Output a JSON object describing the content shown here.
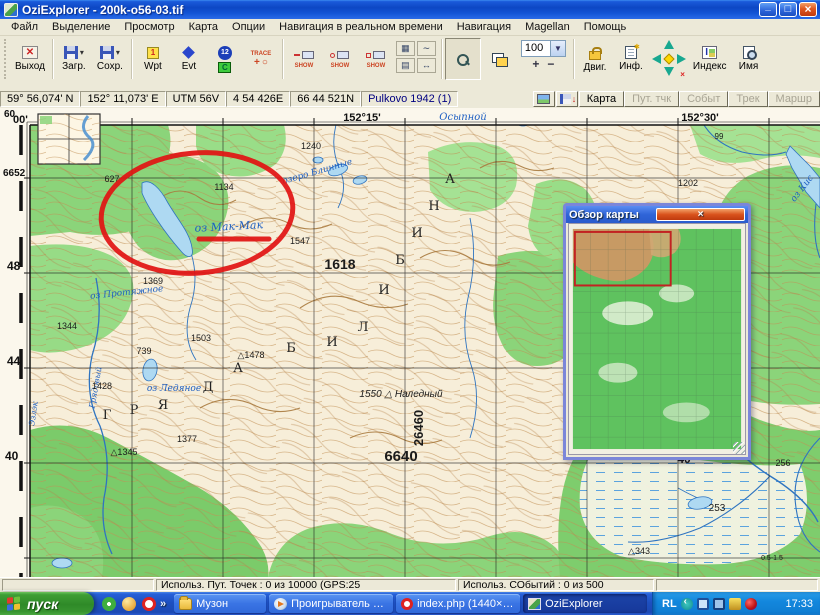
{
  "window": {
    "title": "OziExplorer - 200k-o56-03.tif"
  },
  "menu": {
    "items": [
      "Файл",
      "Выделение",
      "Просмотр",
      "Карта",
      "Опции",
      "Навигация в реальном времени",
      "Навигация",
      "Magellan",
      "Помощь"
    ]
  },
  "toolbar": {
    "exit": "Выход",
    "load": "Загр.",
    "save": "Сохр.",
    "wpt": "Wpt",
    "evt": "Evt",
    "wpt_badge": "1",
    "num_badge": "12",
    "c_badge": "C",
    "trace": "TRACE",
    "plus": "+",
    "circle": "○",
    "show": "SHOW",
    "zoom_value": "100",
    "zoom_in": "+",
    "zoom_out": "−",
    "move": "Двиг.",
    "info": "Инф.",
    "index": "Индекс",
    "name": "Имя"
  },
  "coordbar": {
    "lat": "59° 56,074' N",
    "lon": "152° 11,073' E",
    "utm": "UTM  56V",
    "easting": "4 54 426E",
    "northing": "66 44 521N",
    "datum": "Pulkovo 1942 (1)",
    "tabs": [
      "Карта",
      "Пут. тчк",
      "Событ",
      "Трек",
      "Маршр"
    ]
  },
  "overview": {
    "title": "Обзор карты"
  },
  "statusbar": {
    "waypoints": "Использ. Пут. Точек : 0 из 10000  (GPS:25",
    "events": "Использ. СОбытий : 0 из 500"
  },
  "taskbar": {
    "start": "пуск",
    "chevron": "»",
    "quick_launch": [
      "launch-flower-icon",
      "launch-ball-icon",
      "launch-opera-icon"
    ],
    "tasks": [
      {
        "icon": "folder-icon",
        "label": "Музон"
      },
      {
        "icon": "wmp-icon",
        "label": "Проигрыватель Win..."
      },
      {
        "icon": "opera-icon",
        "label": "index.php (1440×76..."
      },
      {
        "icon": "ozi-icon",
        "label": "OziExplorer",
        "active": true
      }
    ],
    "tray": {
      "label": "RL",
      "icons": [
        "prev-icon",
        "display-icon",
        "display-icon2",
        "volume-icon",
        "guard-icon"
      ],
      "time": "17:33"
    }
  },
  "map": {
    "margin_labels": [
      {
        "t": "60",
        "x": 4,
        "y": 9,
        "s": 10,
        "b": 1
      },
      {
        "t": "00'",
        "x": 13,
        "y": 15,
        "s": 11,
        "b": 1
      },
      {
        "t": "6652",
        "x": 3,
        "y": 68,
        "s": 10,
        "b": 1
      },
      {
        "t": "48",
        "x": 7,
        "y": 162,
        "s": 12,
        "b": 1
      },
      {
        "t": "44",
        "x": 7,
        "y": 257,
        "s": 12,
        "b": 1
      },
      {
        "t": "40",
        "x": 5,
        "y": 352,
        "s": 12,
        "b": 1
      },
      {
        "t": "152°15'",
        "x": 362,
        "y": 13,
        "s": 11,
        "b": 1,
        "a": "middle"
      },
      {
        "t": "152°30'",
        "x": 700,
        "y": 13,
        "s": 11,
        "b": 1,
        "a": "middle"
      }
    ],
    "labels": [
      {
        "t": "627",
        "x": 112,
        "y": 74,
        "s": 9
      },
      {
        "t": "1134",
        "x": 224,
        "y": 82,
        "s": 9
      },
      {
        "t": "1240",
        "x": 311,
        "y": 41,
        "s": 9
      },
      {
        "t": "1202",
        "x": 688,
        "y": 78,
        "s": 9
      },
      {
        "t": "1547",
        "x": 300,
        "y": 136,
        "s": 9
      },
      {
        "t": "1618",
        "x": 340,
        "y": 161,
        "s": 14,
        "b": 1
      },
      {
        "t": "1369",
        "x": 153,
        "y": 176,
        "s": 9
      },
      {
        "t": "1344",
        "x": 67,
        "y": 221,
        "s": 9
      },
      {
        "t": "1503",
        "x": 201,
        "y": 233,
        "s": 9
      },
      {
        "t": "739",
        "x": 144,
        "y": 246,
        "s": 9
      },
      {
        "t": "△1478",
        "x": 251,
        "y": 250,
        "s": 9
      },
      {
        "t": "1428",
        "x": 102,
        "y": 281,
        "s": 9
      },
      {
        "t": "△1345",
        "x": 124,
        "y": 347,
        "s": 9
      },
      {
        "t": "1377",
        "x": 187,
        "y": 334,
        "s": 9
      },
      {
        "t": "1550 △ Наледный",
        "x": 401,
        "y": 289,
        "s": 10,
        "i": 1
      },
      {
        "t": "6640",
        "x": 401,
        "y": 353,
        "s": 15,
        "b": 1
      },
      {
        "t": "26460",
        "x": 423,
        "y": 320,
        "s": 13,
        "b": 1,
        "r": -90
      },
      {
        "t": "99",
        "x": 719,
        "y": 31,
        "s": 8
      },
      {
        "t": "253",
        "x": 717,
        "y": 403,
        "s": 10
      },
      {
        "t": "256",
        "x": 783,
        "y": 358,
        "s": 9
      },
      {
        "t": "40",
        "x": 684,
        "y": 355,
        "s": 12,
        "b": 1
      },
      {
        "t": "△343",
        "x": 639,
        "y": 446,
        "s": 9
      },
      {
        "t": "0.5-1.5",
        "x": 772,
        "y": 452,
        "s": 7
      }
    ],
    "water_labels": [
      {
        "t": "Осыпной",
        "x": 463,
        "y": 12,
        "s": 10
      },
      {
        "t": "озеро Блинные",
        "x": 318,
        "y": 66,
        "s": 9,
        "r": -16
      },
      {
        "t": "оз Мак-Мак",
        "x": 229,
        "y": 122,
        "s": 11,
        "r": -3
      },
      {
        "t": "оз Протяжное",
        "x": 127,
        "y": 187,
        "s": 9,
        "r": -6
      },
      {
        "t": "оз Ледяное",
        "x": 174,
        "y": 283,
        "s": 9
      },
      {
        "t": "оз Кис",
        "x": 804,
        "y": 82,
        "s": 9,
        "r": -52
      },
      {
        "t": "Грядовый",
        "x": 98,
        "y": 280,
        "s": 8,
        "r": -80
      },
      {
        "t": "Эзлэк",
        "x": 36,
        "y": 306,
        "s": 8,
        "r": -82
      }
    ],
    "range_letters": [
      {
        "t": "Г",
        "x": 107,
        "y": 311
      },
      {
        "t": "Р",
        "x": 134,
        "y": 306
      },
      {
        "t": "Я",
        "x": 163,
        "y": 301
      },
      {
        "t": "Д",
        "x": 208,
        "y": 283
      },
      {
        "t": "А",
        "x": 238,
        "y": 264
      },
      {
        "t": "Б",
        "x": 291,
        "y": 244
      },
      {
        "t": "И",
        "x": 332,
        "y": 238
      },
      {
        "t": "Л",
        "x": 363,
        "y": 223
      },
      {
        "t": "И",
        "x": 384,
        "y": 186
      },
      {
        "t": "Б",
        "x": 400,
        "y": 156
      },
      {
        "t": "И",
        "x": 417,
        "y": 129
      },
      {
        "t": "Н",
        "x": 434,
        "y": 102
      },
      {
        "t": "А",
        "x": 450,
        "y": 75
      }
    ]
  }
}
